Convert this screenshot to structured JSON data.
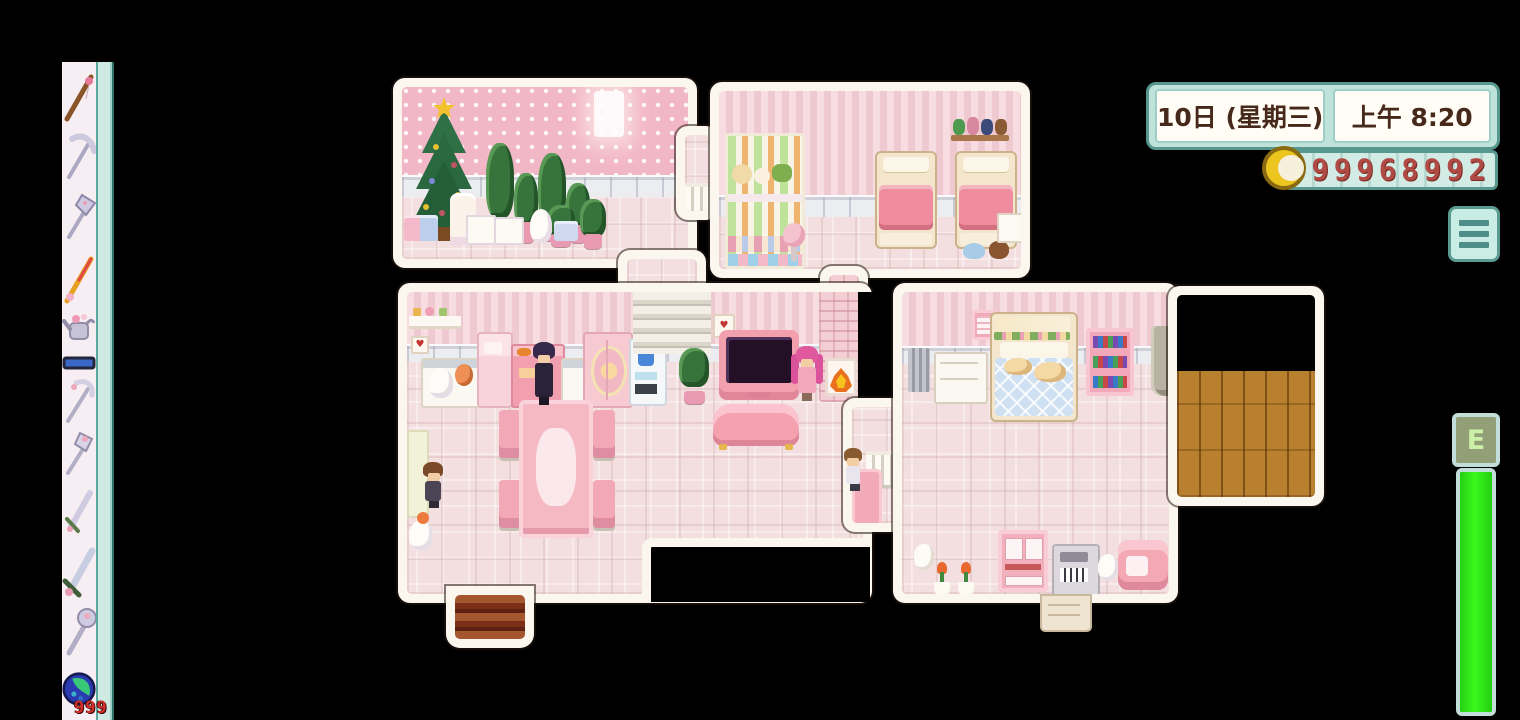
{
  "hud": {
    "date_panel": {
      "date": "10日 (星期三)",
      "time": "上午 8:20"
    },
    "gold_panel": {
      "amount": "99968992",
      "icon": "gold-coin-icon"
    },
    "menu": {
      "icon": "hamburger-menu-icon"
    },
    "energy": {
      "label": "E",
      "fill_percent": 100
    }
  },
  "toolbar": {
    "items": [
      {
        "name": "fishing-pole"
      },
      {
        "name": "pickaxe"
      },
      {
        "name": "axe"
      },
      {
        "name": "fishing-rod-colorful"
      },
      {
        "name": "watering-can"
      },
      {
        "name": "hoe"
      },
      {
        "name": "scythe"
      },
      {
        "name": "tool-pink"
      },
      {
        "name": "sword"
      },
      {
        "name": "galaxy-sword"
      },
      {
        "name": "club"
      },
      {
        "name": "geode",
        "count": "999"
      }
    ]
  },
  "colors": {
    "accent_teal": "#5a9a90",
    "hud_panel": "#bfe3da",
    "gold_text": "#b04a44",
    "energy_green": "#2ce81c",
    "coin_yellow": "#edc51f",
    "theme_pink": "#f2c7d0"
  }
}
